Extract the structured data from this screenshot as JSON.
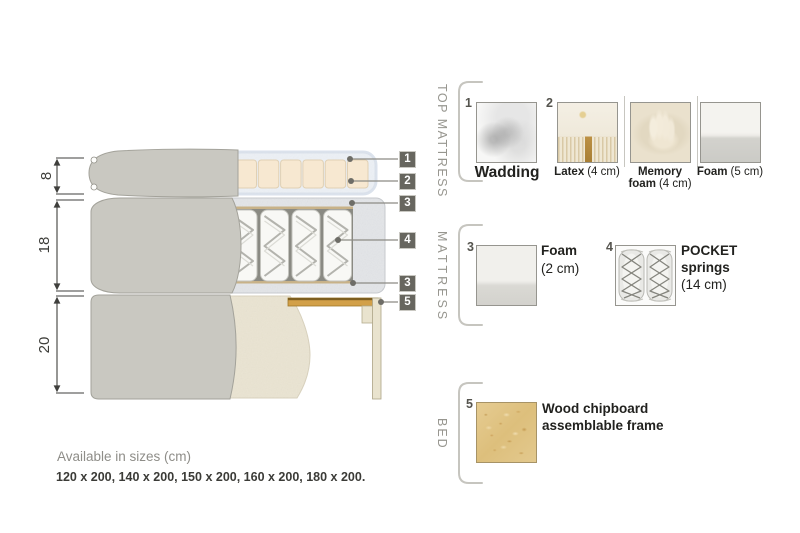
{
  "colors": {
    "tag_bg": "#67665f",
    "cover_gray": "#c9c8c1",
    "wadding_blue_white": "#ecf0f5",
    "latex_cream": "#f7e8d1",
    "foam_speckle_gray": "#e3e5e8",
    "bed_beige": "#eae4d2",
    "wood_slat": "#d2a049",
    "section_label_gray": "#97968f"
  },
  "diagram": {
    "dim_top_mattress_cm": "8",
    "dim_mattress_cm": "18",
    "dim_bed_cm": "20",
    "tags": {
      "t1": "1",
      "t2": "2",
      "t3": "3",
      "t4": "4",
      "t5": "3",
      "t6": "5"
    }
  },
  "panel": {
    "top_mattress": {
      "label": "TOP MATTRESS",
      "item1": {
        "num": "1",
        "name": "Wadding"
      },
      "item2": {
        "num": "2",
        "name": "Latex",
        "size": "(4 cm)"
      },
      "item3": {
        "name_line1": "Memory",
        "name_line2": "foam",
        "size": "(4 cm)"
      },
      "item4": {
        "name": "Foam",
        "size": "(5 cm)"
      }
    },
    "mattress": {
      "label": "MATTRESS",
      "item1": {
        "num": "3",
        "name": "Foam",
        "size": "(2 cm)"
      },
      "item2": {
        "num": "4",
        "name_line1": "POCKET",
        "name_line2": "springs",
        "size": "(14 cm)"
      }
    },
    "bed": {
      "label": "BED",
      "item1": {
        "num": "5",
        "name_line1": "Wood chipboard",
        "name_line2": "assemblable frame"
      }
    }
  },
  "footer": {
    "sizes_title": "Available in sizes (cm)",
    "sizes_list": "120 x 200, 140 x 200, 150 x 200, 160 x 200, 180 x 200."
  }
}
